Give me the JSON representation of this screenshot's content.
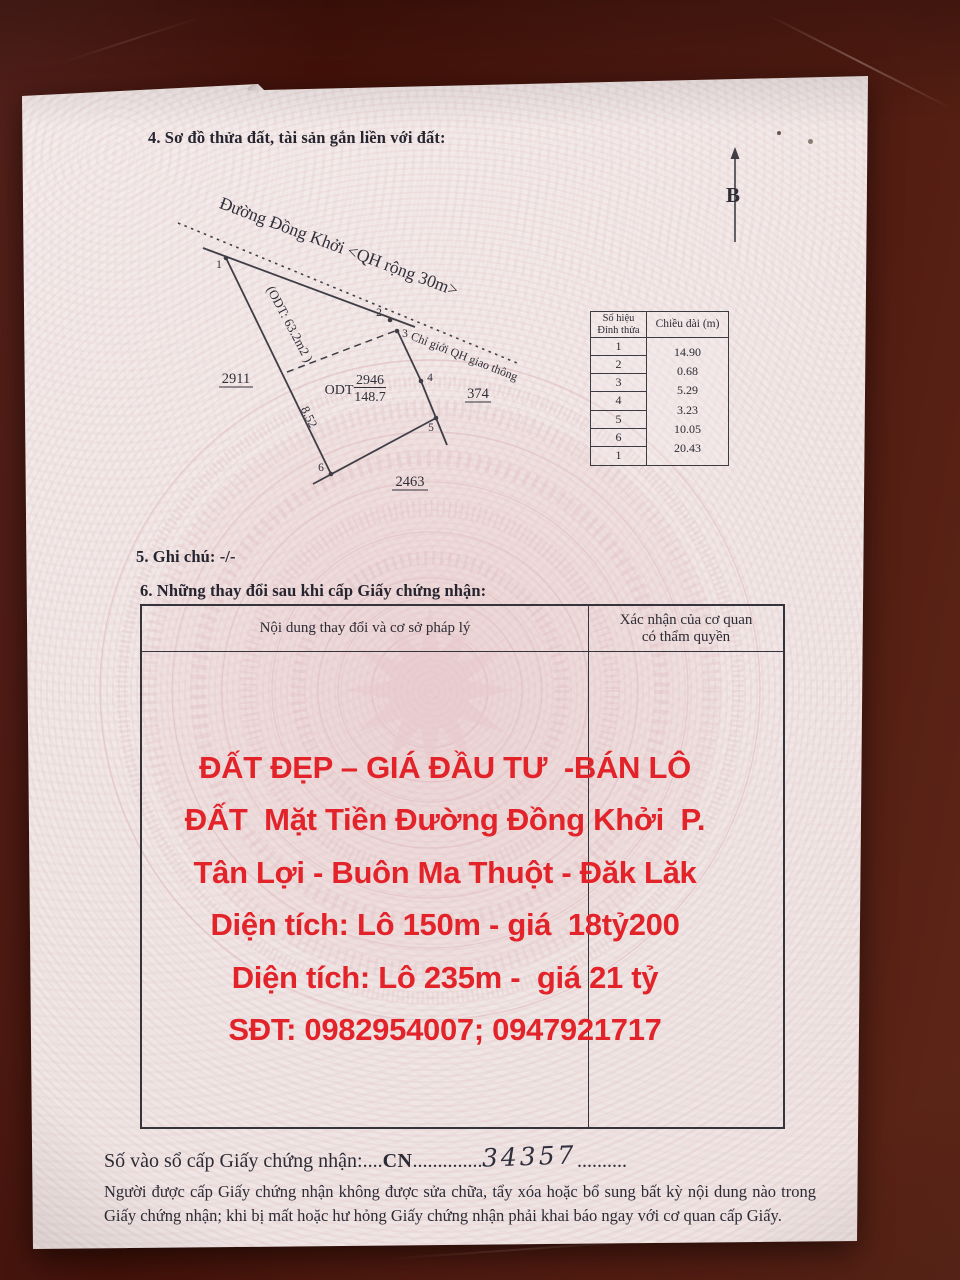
{
  "document": {
    "section4_title": "4. Sơ đồ thửa đất, tài sản gắn liền với đất:",
    "section5_title": "5. Ghi chú: -/-",
    "section6_title": "6. Những thay đổi sau khi cấp Giấy chứng nhận:"
  },
  "diagram": {
    "north_label": "B",
    "road_name": "Đường Đồng Khởi <QH rộng 30m>",
    "planning_boundary_label": "Chỉ giới QH giao thông",
    "strip_area": "(ODT: 63.2m2 )",
    "side_length": "8.52",
    "adjacent_parcel_left": "2911",
    "adjacent_parcel_right": "374",
    "adjacent_parcel_bottom": "2463",
    "land_use_code": "ODT",
    "parcel_number": "2946",
    "parcel_area": "148.7",
    "vertices": [
      "1",
      "2",
      "3",
      "4",
      "5",
      "6"
    ]
  },
  "vertex_table": {
    "col1_header_line1": "Số hiệu",
    "col1_header_line2": "Đỉnh thửa",
    "col2_header": "Chiều dài (m)",
    "vertex_ids": [
      "1",
      "2",
      "3",
      "4",
      "5",
      "6",
      "1"
    ],
    "lengths": [
      "14.90",
      "0.68",
      "5.29",
      "3.23",
      "10.05",
      "20.43"
    ]
  },
  "changes_table": {
    "col1_header": "Nội dung thay đổi và cơ sở pháp lý",
    "col2_header_line1": "Xác nhận của cơ quan",
    "col2_header_line2": "có thẩm quyền"
  },
  "ad_overlay": {
    "color": "#e3232a",
    "lines": [
      "ĐẤT ĐẸP – GIÁ ĐẦU TƯ  -BÁN LÔ",
      "ĐẤT  Mặt Tiền Đường Đồng Khởi  P.",
      "Tân Lợi - Buôn Ma Thuột - Đăk Lăk",
      "Diện tích: Lô 150m - giá  18tỷ200",
      "Diện tích: Lô 235m -  giá 21 tỷ",
      "SĐT: 0982954007; 0947921717"
    ]
  },
  "registry": {
    "label": "Số vào sổ cấp Giấy chứng nhận:",
    "dots_before": "....",
    "code": "CN",
    "dots_middle": "..............",
    "number": "34357",
    "dots_after": ".........."
  },
  "footer_note": "Người được cấp Giấy chứng nhận không được sửa chữa, tẩy xóa hoặc bổ sung bất kỳ nội dung nào trong Giấy chứng nhận; khi bị mất hoặc hư hỏng Giấy chứng nhận phải khai báo ngay với cơ quan cấp Giấy."
}
